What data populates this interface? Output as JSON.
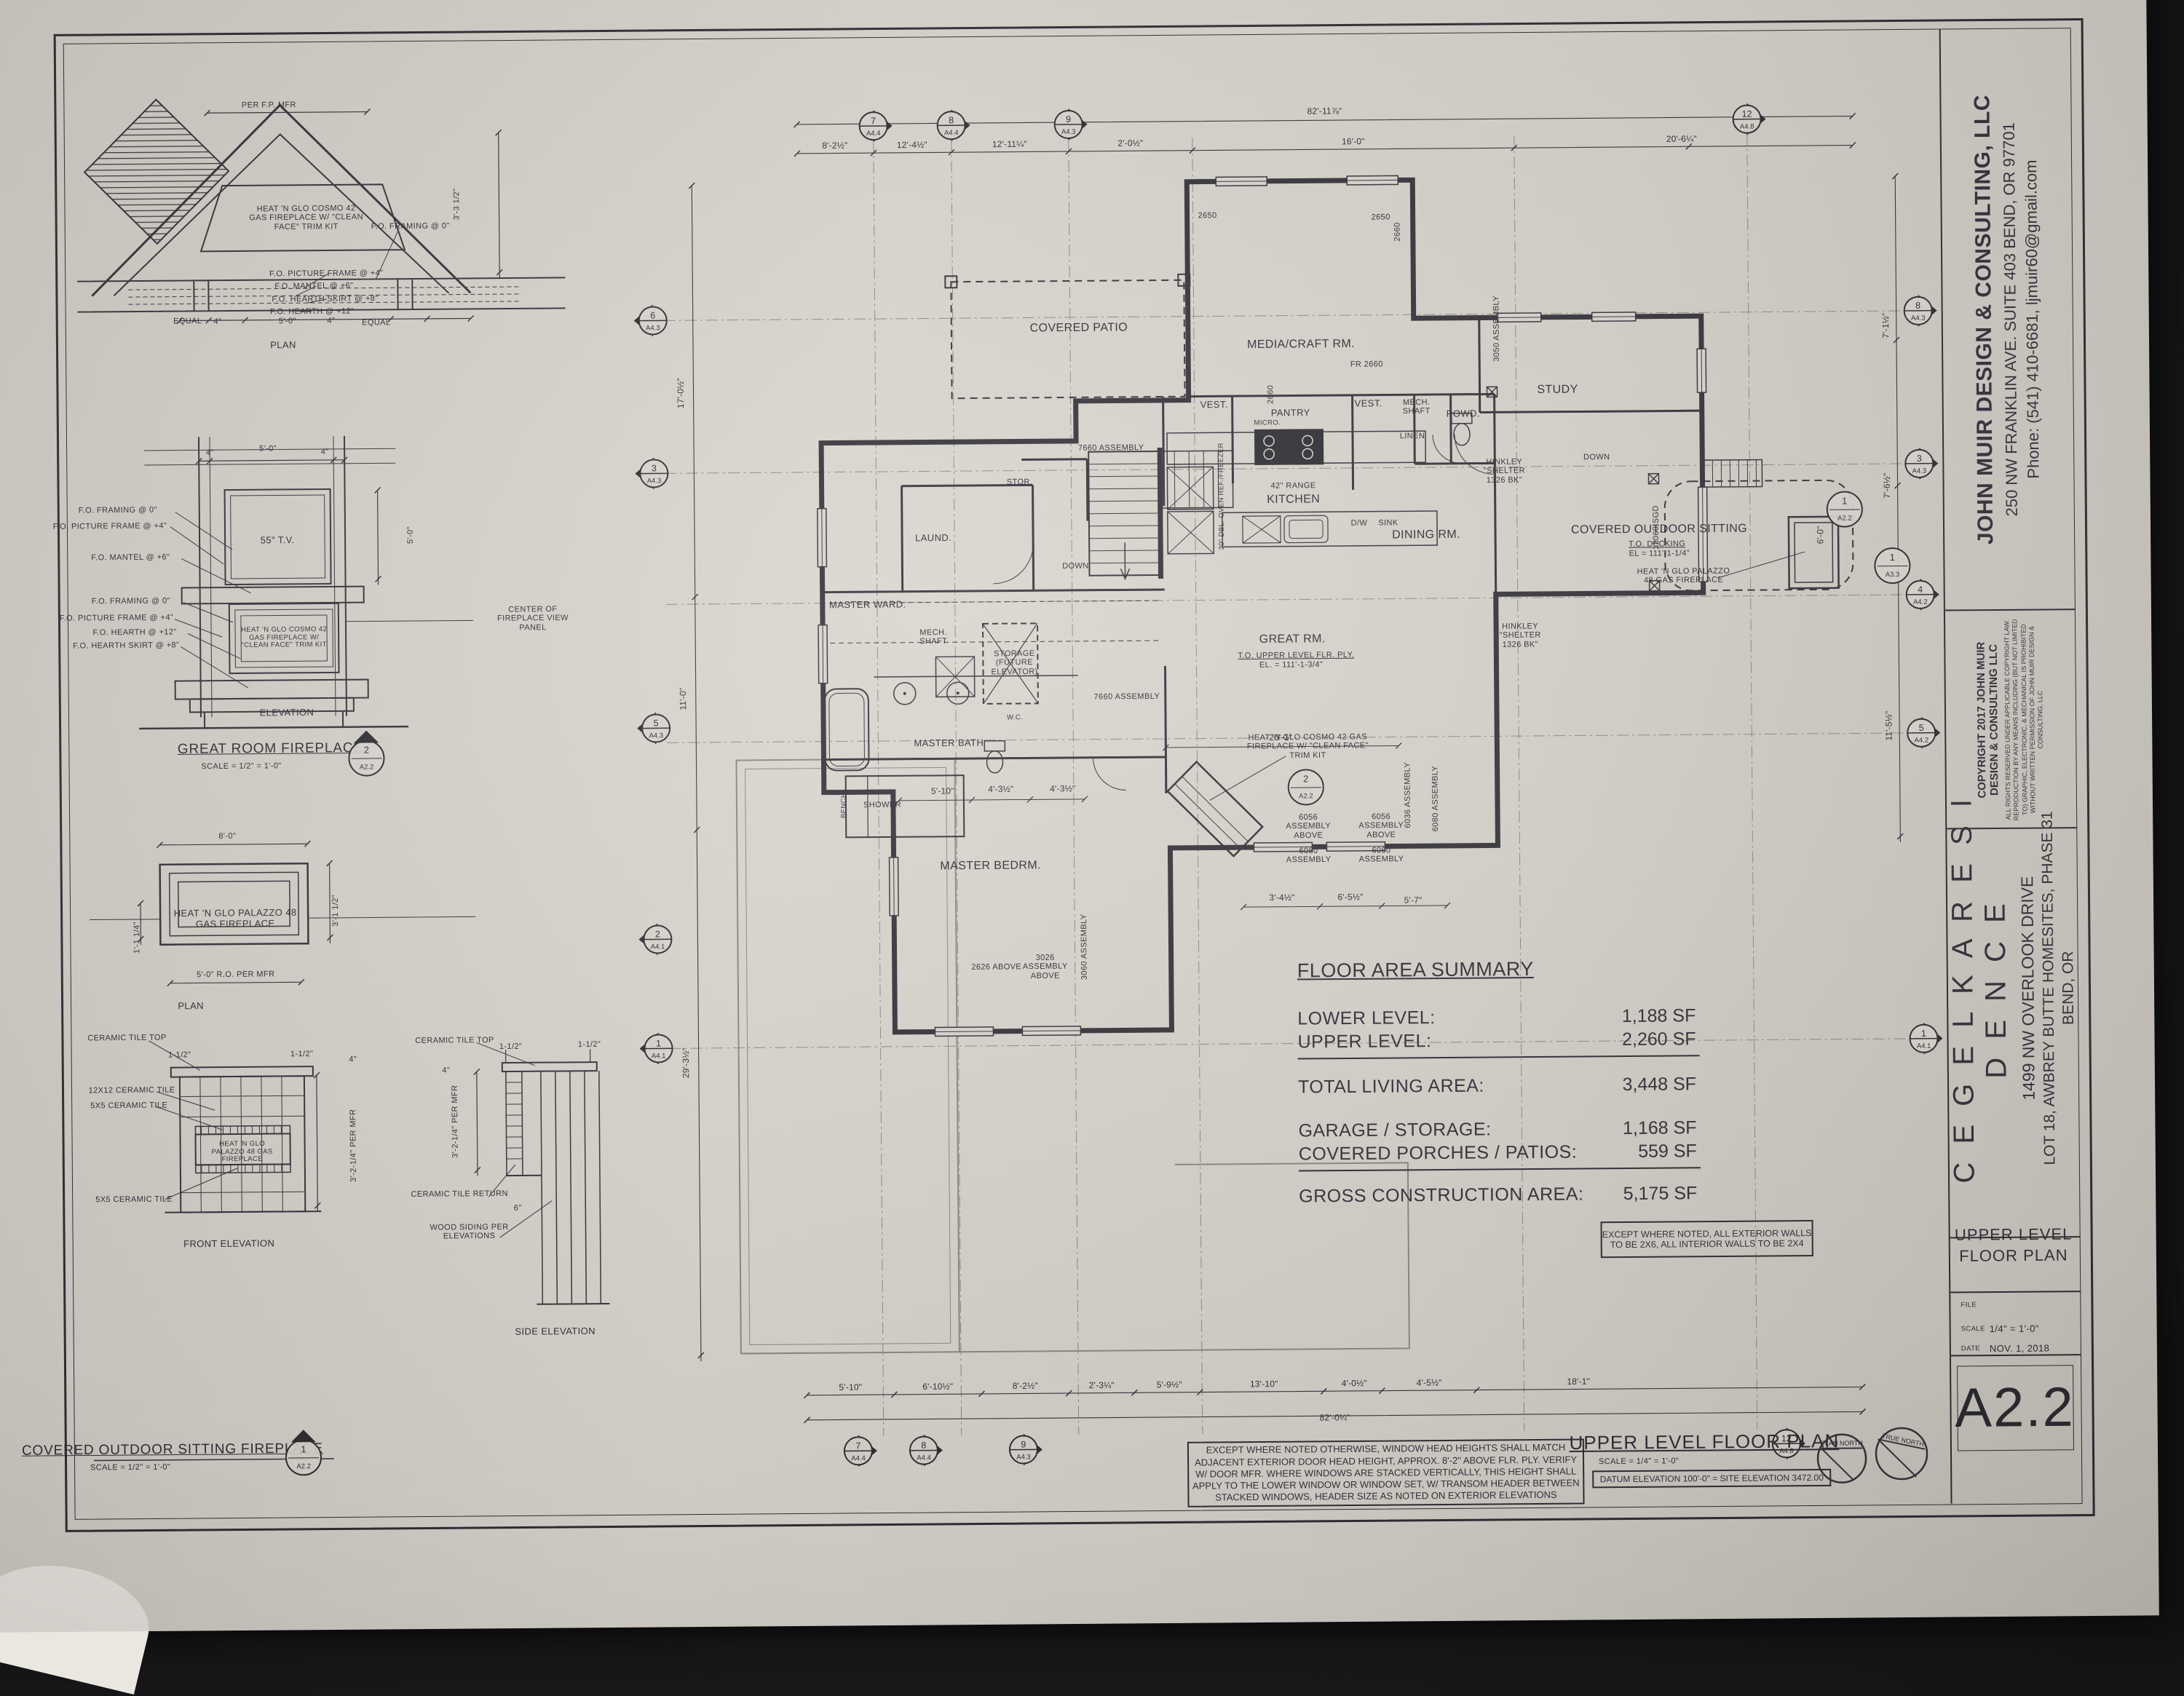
{
  "sheet": {
    "firm": {
      "name": "JOHN MUIR DESIGN & CONSULTING, LLC",
      "address": "250 NW FRANKLIN AVE. SUITE 403 BEND, OR 97701",
      "phone": "Phone: (541) 410-6681, ljmuir60@gmail.com"
    },
    "copyright": {
      "title1": "COPYRIGHT 2017 JOHN MUIR",
      "title2": "DESIGN & CONSULTING LLC",
      "body": "ALL RIGHTS RESERVED UNDER APPLICABLE COPYRIGHT LAW. REPRODUCTION BY ANY MEANS INCLUDING (BUT NOT LIMITED TO) GRAPHIC, ELECTRONIC, & MECHANICAL IS PROHIBITED WITHOUT WRITTEN PERMISSION OF JOHN MUIR DESIGN & CONSULTING, LLC"
    },
    "project": {
      "name": "C E G E L K A   R E S I D E N C E",
      "addr1": "1499 NW OVERLOOK DRIVE",
      "addr2": "LOT 18, AWBREY BUTTE HOMESITES, PHASE 31",
      "addr3": "BEND, OR"
    },
    "sheet_title1": "UPPER LEVEL",
    "sheet_title2": "FLOOR PLAN",
    "file_label": "FILE",
    "scale_label": "SCALE",
    "scale_value": "1/4\" = 1'-0\"",
    "date_label": "DATE",
    "date_value": "NOV. 1, 2018",
    "number": "A2.2"
  },
  "summary": {
    "title": "FLOOR AREA SUMMARY",
    "rows": [
      {
        "label": "LOWER LEVEL:",
        "value": "1,188 SF"
      },
      {
        "label": "UPPER LEVEL:",
        "value": "2,260 SF"
      },
      {
        "label": "TOTAL LIVING AREA:",
        "value": "3,448 SF"
      },
      {
        "label": "GARAGE / STORAGE:",
        "value": "1,168 SF"
      },
      {
        "label": "COVERED PORCHES / PATIOS:",
        "value": "559 SF"
      },
      {
        "label": "GROSS CONSTRUCTION AREA:",
        "value": "5,175 SF"
      }
    ]
  },
  "plan": {
    "title": "UPPER LEVEL FLOOR PLAN",
    "title_scale": "SCALE = 1/4\" = 1'-0\"",
    "datum_note": "DATUM ELEVATION 100'-0\" = SITE ELEVATION 3472.00",
    "north_plan": "PLAN NORTH",
    "north_true": "TRUE NORTH",
    "wall_note": "EXCEPT WHERE NOTED, ALL EXTERIOR WALLS TO BE 2X6, ALL INTERIOR WALLS TO BE 2X4",
    "window_note": "EXCEPT WHERE NOTED OTHERWISE, WINDOW HEAD HEIGHTS SHALL MATCH ADJACENT EXTERIOR DOOR HEAD HEIGHT, APPROX. 8'-2\" ABOVE FLR. PLY. VERIFY W/ DOOR MFR. WHERE WINDOWS ARE STACKED VERTICALLY, THIS HEIGHT SHALL APPLY TO THE LOWER WINDOW OR WINDOW SET, W/ TRANSOM HEADER BETWEEN STACKED WINDOWS, HEADER SIZE AS NOTED ON EXTERIOR ELEVATIONS",
    "rooms": {
      "media": "MEDIA/CRAFT RM.",
      "study": "STUDY",
      "vest1": "VEST.",
      "vest2": "VEST.",
      "pantry": "PANTRY",
      "micro": "MICRO.",
      "kitchen": "KITCHEN",
      "range": "42\" RANGE",
      "dw": "D/W",
      "sink": "SINK",
      "ref": "REF./FREEZER",
      "oven": "30\" DBL. OVEN",
      "mech1": "MECH. SHAFT",
      "powd": "POWD.",
      "linen": "LINEN",
      "dining": "DINING RM.",
      "patio": "COVERED PATIO",
      "sitting": "COVERED OUTDOOR SITTING",
      "deck_note": "T.O. DECKING",
      "deck_el": "EL = 111'-1-1/4\"",
      "great": "GREAT RM.",
      "great_note": "T.O. UPPER LEVEL FLR. PLY.",
      "great_el": "EL. = 111'-1-3/4\"",
      "laund": "LAUND.",
      "stor": "STOR.",
      "ward": "MASTER WARD.",
      "mech2": "MECH. SHAFT",
      "elev": "STORAGE (FUTURE ELEVATOR)",
      "bath": "MASTER BATH",
      "shower": "SHOWER",
      "bench": "BENCH",
      "wc": "W.C.",
      "bedrm": "MASTER BEDRM.",
      "down": "DOWN",
      "palazzo": "HEAT 'N GLO PALAZZO 48 GAS FIREPLACE",
      "cosmo": "HEAT 'N GLO COSMO 42 GAS FIREPLACE W/ \"CLEAN FACE\" TRIM KIT",
      "hinkley": "HINKLEY \"SHELTER 1326 BK\""
    },
    "tags": {
      "w2650": "2650",
      "w2660": "2660",
      "fr2660": "FR 2660",
      "a3050": "3050 ASSEMBLY",
      "a7660": "7660 ASSEMBLY",
      "a6056": "6056 ASSEMBLY ABOVE",
      "a6080": "6080 ASSEMBLY",
      "a6036": "6036 ASSEMBLY",
      "sgd": "12060 SGD",
      "a2626": "2626 ABOVE",
      "a3026": "3026 ASSEMBLY ABOVE",
      "a3060": "3060 ASSEMBLY"
    },
    "dims_top": [
      "8'-2½\"",
      "12'-4½\"",
      "12'-11¼\"",
      "2'-0½\"",
      "16'-0\"",
      "20'-6¼\""
    ],
    "dim_top_overall": "82'-11⅞\"",
    "dims_bottom": [
      "5'-10\"",
      "6'-10½\"",
      "8'-2½\"",
      "2'-3¼\"",
      "5'-9½\"",
      "13'-10\"",
      "4'-0½\"",
      "4'-5½\"",
      "18'-1\""
    ],
    "dim_bottom_overall": "82'-0¼\"",
    "dims_left": [
      "17'-0½\"",
      "11'-0\"",
      "29'-3½\""
    ],
    "dims_right": [
      "7'-1½\"",
      "7'-6½\"",
      "11'-5½\""
    ],
    "dim_sitting": "6'-0\"",
    "inner_dims": [
      "20'-1\"",
      "3'-4½\"",
      "6'-5½\"",
      "5'-7\"",
      "5'-10\"",
      "4'-3½\"",
      "4'-3½\""
    ],
    "markers": {
      "top": [
        {
          "num": "7",
          "sheet": "A4.4"
        },
        {
          "num": "8",
          "sheet": "A4.4"
        },
        {
          "num": "9",
          "sheet": "A4.3"
        },
        {
          "num": "12",
          "sheet": "A4.8"
        }
      ],
      "bottom": [
        {
          "num": "7",
          "sheet": "A4.4"
        },
        {
          "num": "8",
          "sheet": "A4.4"
        },
        {
          "num": "9",
          "sheet": "A4.3"
        },
        {
          "num": "12",
          "sheet": "A4.8"
        }
      ],
      "left": [
        {
          "num": "6",
          "sheet": "A4.3"
        },
        {
          "num": "3",
          "sheet": "A4.3"
        },
        {
          "num": "5",
          "sheet": "A4.3"
        },
        {
          "num": "2",
          "sheet": "A4.1"
        },
        {
          "num": "1",
          "sheet": "A4.1"
        }
      ],
      "right": [
        {
          "num": "8",
          "sheet": "A4.3"
        },
        {
          "num": "3",
          "sheet": "A4.3"
        },
        {
          "num": "4",
          "sheet": "A4.2"
        },
        {
          "num": "5",
          "sheet": "A4.2"
        },
        {
          "num": "1",
          "sheet": "A4.1"
        }
      ],
      "cosmo": {
        "num": "2",
        "sheet": "A2.2"
      },
      "sitting": {
        "num": "1",
        "sheet": "A2.2"
      },
      "a33": {
        "num": "1",
        "sheet": "A3.3"
      }
    }
  },
  "details": {
    "grf": {
      "title": "GREAT ROOM FIREPLACE",
      "scale": "SCALE = 1/2\" = 1'-0\"",
      "plan_label": "PLAN",
      "elevation_label": "ELEVATION",
      "dim_mfr": "PER F.P. MFR",
      "note": "HEAT 'N GLO COSMO 42 GAS FIREPLACE W/ \"CLEAN FACE\" TRIM KIT",
      "callout_framing": "F.O. FRAMING @ 0\"",
      "callout_picture": "F.O. PICTURE FRAME @ +4\"",
      "callout_mantel": "F.O. MANTEL @ +6\"",
      "callout_hearth_skirt": "F.O. HEARTH SKIRT @ +8\"",
      "callout_hearth": "F.O. HEARTH @ +12\"",
      "tv": "55\" T.V.",
      "center_note": "CENTER OF FIREPLACE VIEW PANEL",
      "dim_equal": "EQUAL",
      "dim_4": "4\"",
      "dim_5": "5'-0\"",
      "dim_332": "3'-3 1/2\"",
      "marker_num": "2",
      "marker_sheet": "A2.2"
    },
    "cof": {
      "title": "COVERED OUTDOOR SITTING FIREPLACE",
      "scale": "SCALE = 1/2\" = 1'-0\"",
      "plan_label": "PLAN",
      "front_label": "FRONT ELEVATION",
      "side_label": "SIDE ELEVATION",
      "note": "HEAT 'N GLO PALAZZO 48 GAS FIREPLACE",
      "dim_80": "8'-0\"",
      "dim_ro": "5'-0\" R.O. PER MFR",
      "dim_114": "1'-1 1/4\"",
      "dim_312": "3'-1 1/2\"",
      "tile_top": "CERAMIC TILE TOP",
      "tile_12": "12X12 CERAMIC TILE",
      "tile_5": "5X5 CERAMIC TILE",
      "tile_return": "CERAMIC TILE RETURN",
      "wood_siding": "WOOD SIDING PER ELEVATIONS",
      "dim_112": "1-1/2\"",
      "dim_per_mfr": "3'-2-1/4\" PER MFR",
      "dim_6": "6\"",
      "dim_4": "4\"",
      "marker_num": "1",
      "marker_sheet": "A2.2"
    }
  }
}
